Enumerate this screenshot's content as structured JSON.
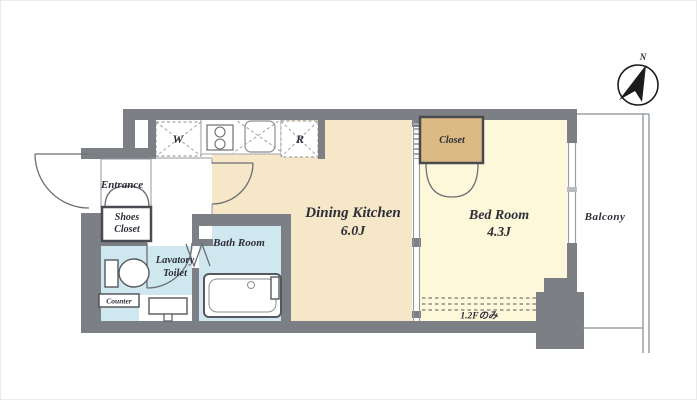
{
  "floorplan": {
    "rooms": {
      "entrance": {
        "label": "Entrance"
      },
      "shoes_closet": {
        "line1": "Shoes",
        "line2": "Closet"
      },
      "lavatory_toilet": {
        "line1": "Lavatory",
        "line2": "Toilet"
      },
      "counter": {
        "label": "Counter"
      },
      "bath_room": {
        "label": "Bath Room"
      },
      "dining_kitchen": {
        "label": "Dining Kitchen",
        "size": "6.0J"
      },
      "bed_room": {
        "label": "Bed Room",
        "size": "4.3J"
      },
      "closet": {
        "label": "Closet"
      },
      "balcony": {
        "label": "Balcony"
      }
    },
    "appliances": {
      "washer_symbol": "W",
      "refrigerator_symbol": "R"
    },
    "annotations": {
      "floor_note": "1.2Fのみ"
    },
    "compass": {
      "north_label": "N"
    },
    "colors": {
      "wall": "#7c7f84",
      "dining_kitchen_floor": "#f7e7c9",
      "bed_room_floor": "#fdf8da",
      "closet_fill": "#dcba84",
      "wet_area_floor": "#cfe8ef",
      "text": "#2e2e38"
    }
  }
}
